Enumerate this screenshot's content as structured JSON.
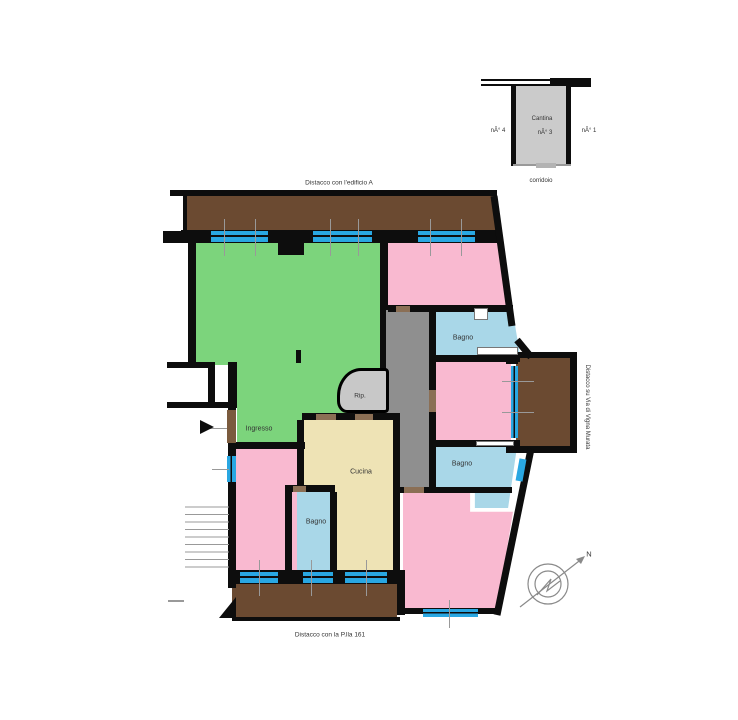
{
  "plan": {
    "title_top": "Distacco con l'edificio A",
    "title_bottom": "Distacco con la P.lla 161",
    "title_right": "Distacco su Via di Vigna Murata",
    "compass_north": "N"
  },
  "cellar": {
    "room_label": "Cantina",
    "room_number": "nÂ° 3",
    "left_number": "nÂ° 4",
    "right_number": "nÂ° 1",
    "corridor_label": "corridoio"
  },
  "rooms": {
    "ingresso": "Ingresso",
    "cucina": "Cucina",
    "rip": "Rip.",
    "bagno1": "Bagno",
    "bagno2": "Bagno",
    "bagno3": "Bagno"
  },
  "colors": {
    "wall": "#0d0d0d",
    "balcony_brown": "#6b4a31",
    "living_green": "#7cd47c",
    "bedroom_pink": "#f9b9d0",
    "bathroom_blue": "#a9d7e8",
    "kitchen_cream": "#eee3b5",
    "corridor_gray": "#8f8f8f",
    "window_blue": "#29a7e2",
    "door_brown": "#8b6f55",
    "cellar_gray": "#cbcbcb"
  }
}
